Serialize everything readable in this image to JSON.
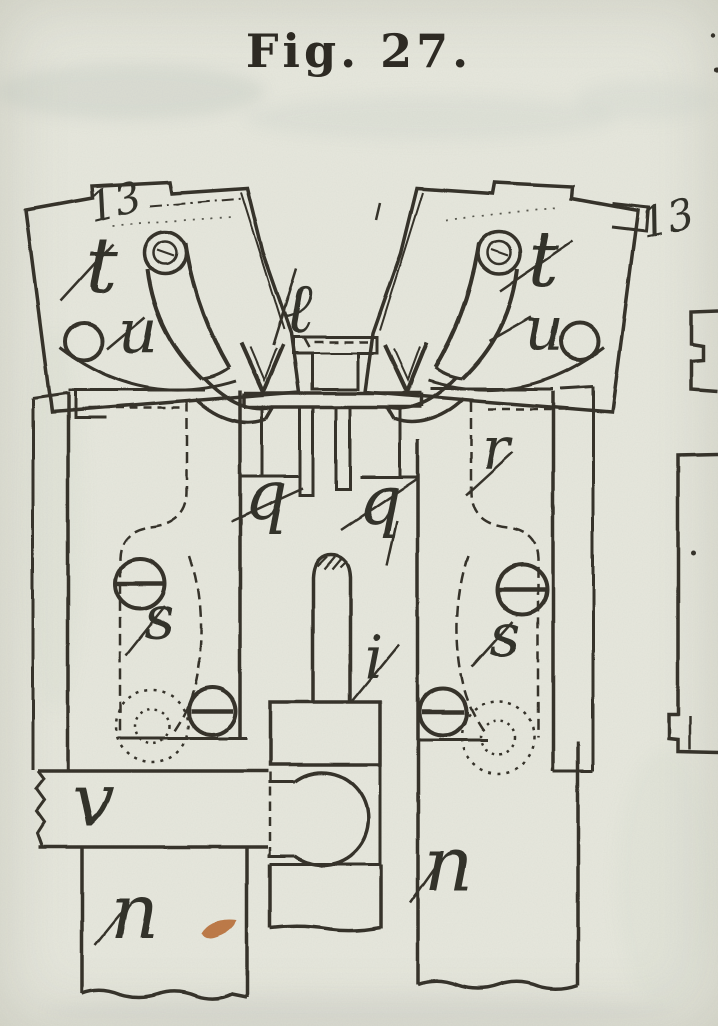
{
  "figure": {
    "title": "Fig. 27."
  },
  "colors": {
    "paper": "#e6e7dd",
    "ink": "#36332b",
    "stain": "#b5662e"
  },
  "labels": {
    "ref_left": "13",
    "t_left": "t",
    "u_left": "u",
    "l_center": "ℓ",
    "t_right": "t",
    "u_right": "u",
    "ref_right": "13",
    "r_right": "r",
    "q_left": "q",
    "q_right": "q",
    "s_left": "s",
    "s_right": "s",
    "i_center": "i",
    "v_bar": "v",
    "n_left": "n",
    "n_right": "n"
  }
}
